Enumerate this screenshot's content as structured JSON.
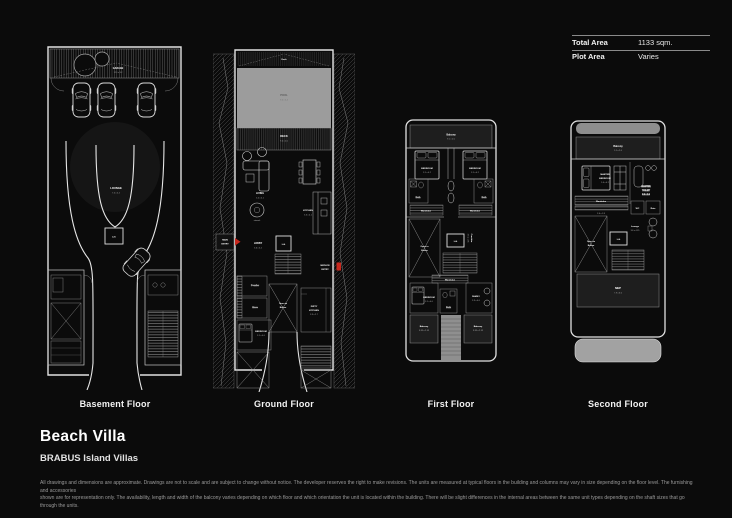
{
  "page": {
    "bg": "#0b0b0b",
    "accent_red": "#c8281e"
  },
  "info": {
    "rows": [
      {
        "label": "Total Area",
        "value": "1133 sqm."
      },
      {
        "label": "Plot Area",
        "value": "Varies"
      }
    ]
  },
  "title": {
    "name": "Beach Villa",
    "subtitle": "BRABUS Island Villas"
  },
  "floor_labels": {
    "basement": "Basement Floor",
    "ground": "Ground Floor",
    "first": "First Floor",
    "second": "Second Floor"
  },
  "rooms": {
    "basement": {
      "garage": "GARAGE",
      "garage_dims": "12.9 x 3.2",
      "lounge": "LOUNGE",
      "lounge_dims": "7.5 x 5.2",
      "lift": "Lift"
    },
    "ground": {
      "deck_top": "Deck",
      "pool": "POOL",
      "pool_dims": "9.4 x 5.4",
      "deck": "DECK",
      "deck_dims": "9.4 x 2.0",
      "living": "LIVING",
      "living_dims": "5.5 x 5.1",
      "artwork": "artwork",
      "main_entry_1": "MAIN",
      "main_entry_2": "ENTRY",
      "lobby": "LOBBY",
      "lobby_dims": "3.6 x 3.2",
      "lift": "Lift",
      "open_1": "Open to",
      "open_2": "Below",
      "powder": "Powder",
      "store": "Store",
      "bedroom": "BEDROOM",
      "bedroom_dims": "3.1 x 4.0",
      "dirty_1": "DIRTY",
      "dirty_2": "KITCHEN",
      "dirty_dims": "3.3 x 2.7",
      "kitchen": "KITCHEN",
      "kitchen_dims": "3.3 x 4.1",
      "service_1": "SERVICE",
      "service_2": "ENTRY"
    },
    "first": {
      "balcony": "Balcony",
      "balcony_dims": "9.1 x 2.0",
      "bedroom1": "BEDROOM",
      "bedroom1_dims": "3.1 x 4.2",
      "bedroom2": "BEDROOM",
      "bedroom2_dims": "3.1 x 4.2",
      "bath1": "Bath",
      "bath2": "Bath",
      "wardrobe1": "Wardrobe",
      "wardrobe2": "Wardrobe",
      "open_1": "Open to",
      "open_2": "Below",
      "lift": "Lift",
      "corridor": "Corridor",
      "corridor_dims": "3.6 x 1.35",
      "wardrobe3": "Wardrobe",
      "bedroom3": "BEDROOM",
      "bedroom3_dims": "3.1 x 4.0",
      "bath3": "Bath",
      "family": "FAMILY",
      "family_dims": "3.3 x 4.0",
      "balcony1": "Balcony",
      "balcony1_dims": "3.85 x 2.35",
      "balcony2": "Balcony",
      "balcony2_dims": "3.85 x 2.35"
    },
    "second": {
      "balcony": "Balcony",
      "balcony_dims": "9.1 x 2.6",
      "master_1": "MASTER",
      "master_2": "BEDROOM",
      "master_dims": "5.4 x 4.2",
      "toilet_1": "MASTER",
      "toilet_2": "TOILET",
      "toilet_dims": "3.3 x 2.6",
      "wardrobe": "Wardrobe",
      "wardrobe_dims": "3.6 x 1.8",
      "wc": "WC",
      "rain": "Rain",
      "open_1": "Open to",
      "open_2": "Below",
      "lounge": "Lounge",
      "lounge_dims": "3.6 x 4.35",
      "lift": "Lift",
      "mep": "MEP",
      "mep_dims": "7.9 x 3.6"
    }
  },
  "disclaimer": {
    "line1": "All drawings and dimensions are approximate. Drawings are not to scale and are subject to change without notice. The developer reserves the right to make revisions. The units are measured at typical floors in the building and columns may vary in size depending on the floor level. The furnishing and accessories",
    "line2": "shown are for representation only. The availability, length and width of the balcony varies depending on which floor and which orientation the unit is located within the building. There will be slight differences in the internal areas between the same unit types depending on the shaft sizes that go through the units."
  }
}
